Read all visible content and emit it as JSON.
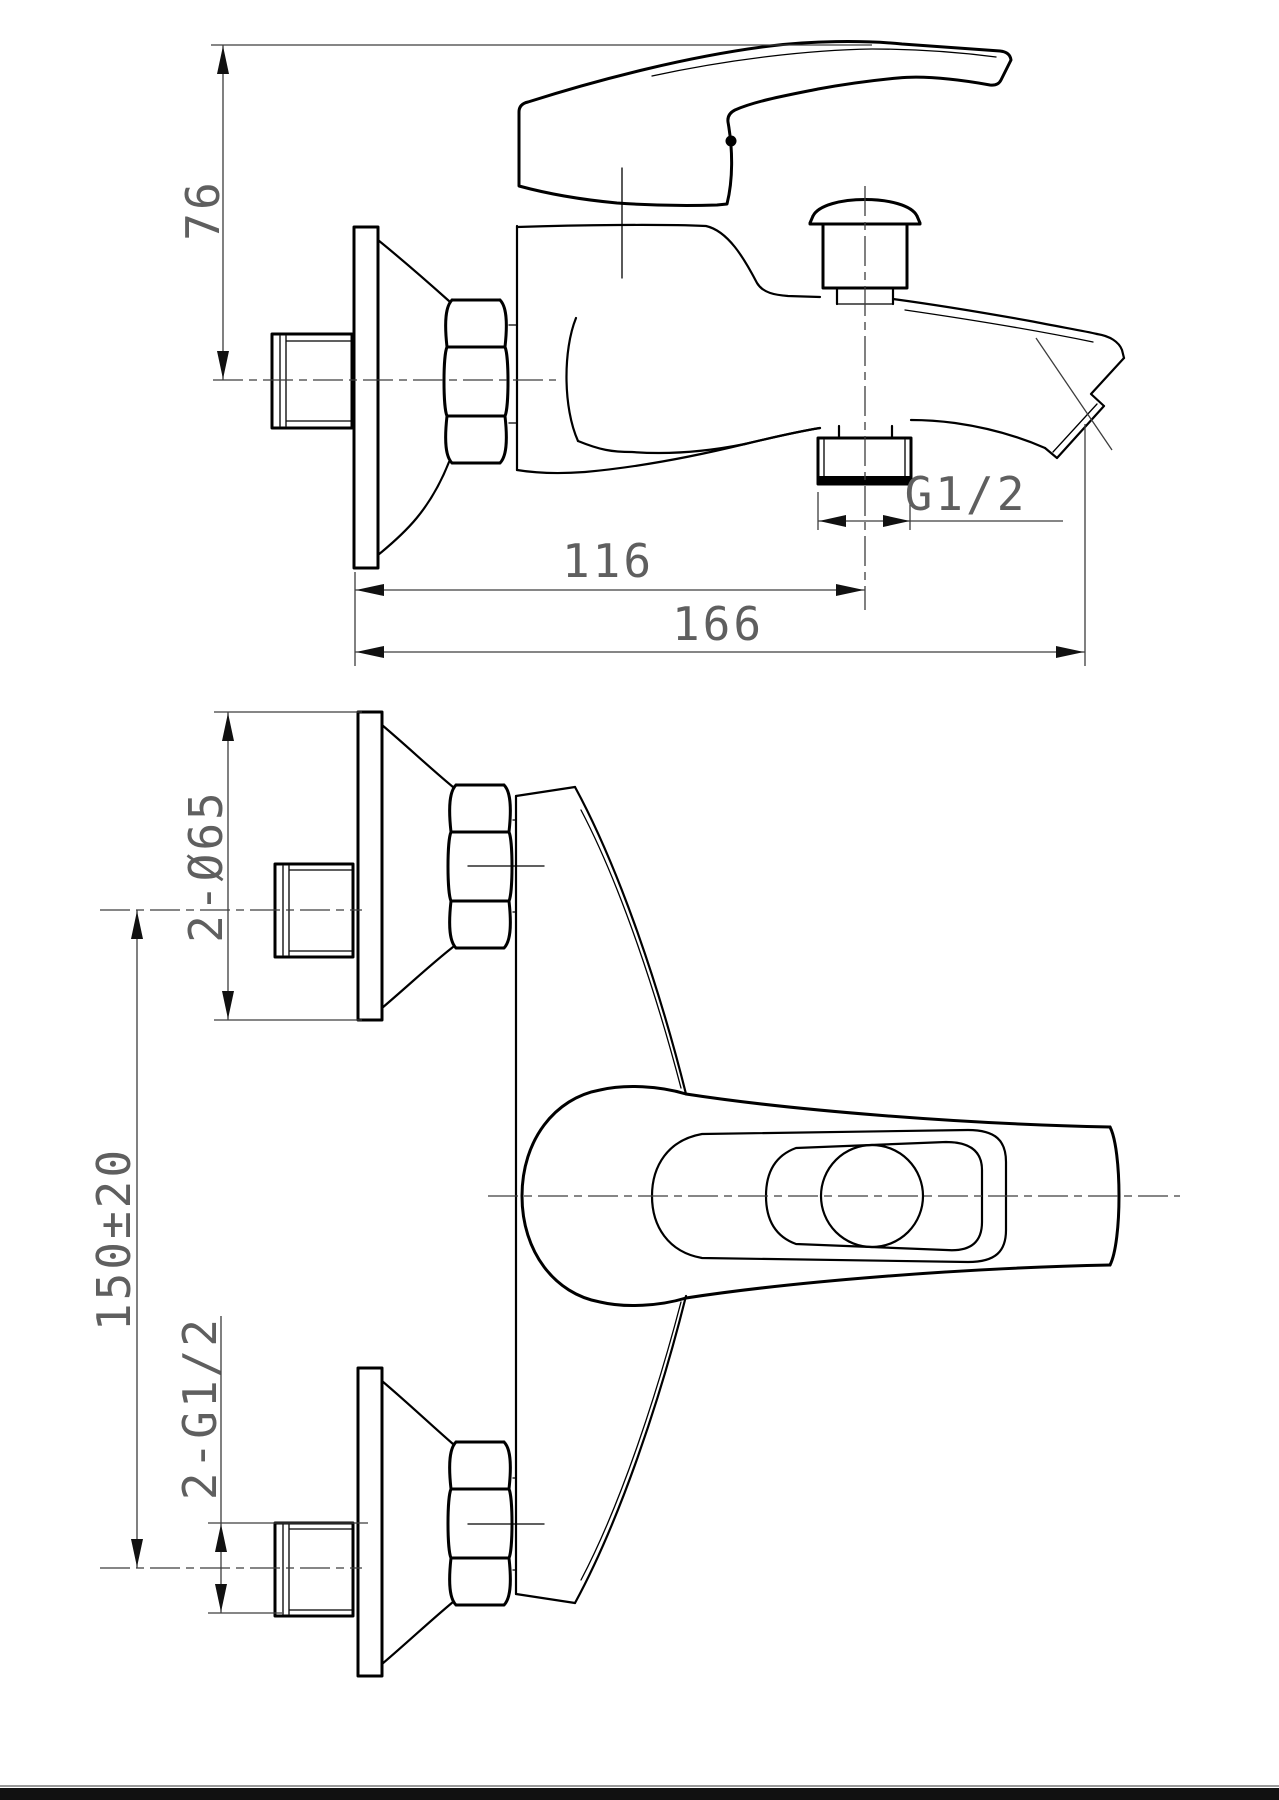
{
  "drawing": {
    "dimensions": {
      "spout_height": "76",
      "wall_to_shower_outlet": "116",
      "total_reach": "166",
      "shower_outlet_thread": "G1/2",
      "escutcheon_diameter": "2-Ø65",
      "inlet_centres": "150±20",
      "inlet_thread": "2-G1/2"
    },
    "colors": {
      "line": "#000000",
      "dimension": "#3d3d3d",
      "dimension_text": "#5f5f5f",
      "background": "#ffffff",
      "footer_bar": "#111111"
    }
  }
}
